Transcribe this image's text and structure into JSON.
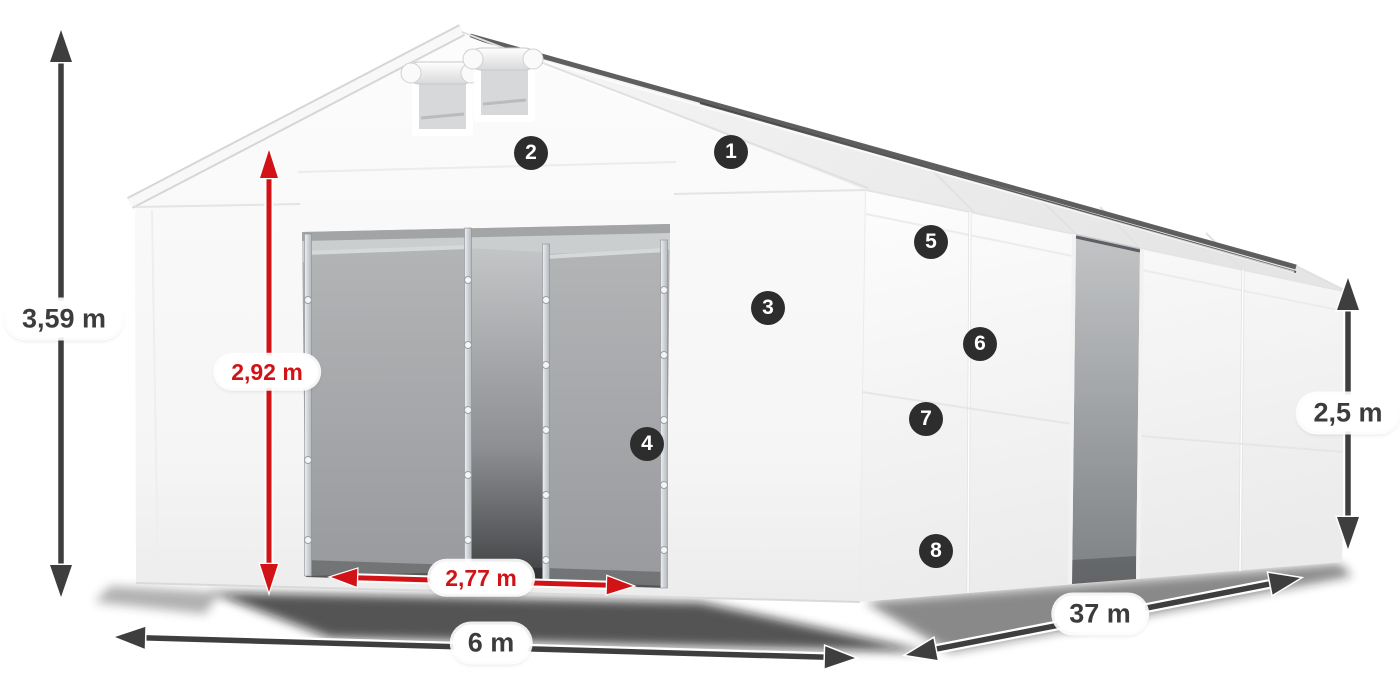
{
  "diagram": {
    "markers": [
      {
        "number": "1"
      },
      {
        "number": "2"
      },
      {
        "number": "3"
      },
      {
        "number": "4"
      },
      {
        "number": "5"
      },
      {
        "number": "6"
      },
      {
        "number": "7"
      },
      {
        "number": "8"
      }
    ],
    "dimensions": {
      "total_height": "3,59 m",
      "entrance_height": "2,92 m",
      "entrance_width": "2,77 m",
      "front_width": "6 m",
      "side_length": "37 m",
      "side_height": "2,5 m"
    },
    "colors": {
      "measurement_dark": "#3e3e3e",
      "measurement_red": "#d11217",
      "badge_background": "#2d2d2d",
      "badge_text": "#ffffff",
      "label_background": "#ffffff",
      "label_text": "#3c3c3c"
    }
  }
}
